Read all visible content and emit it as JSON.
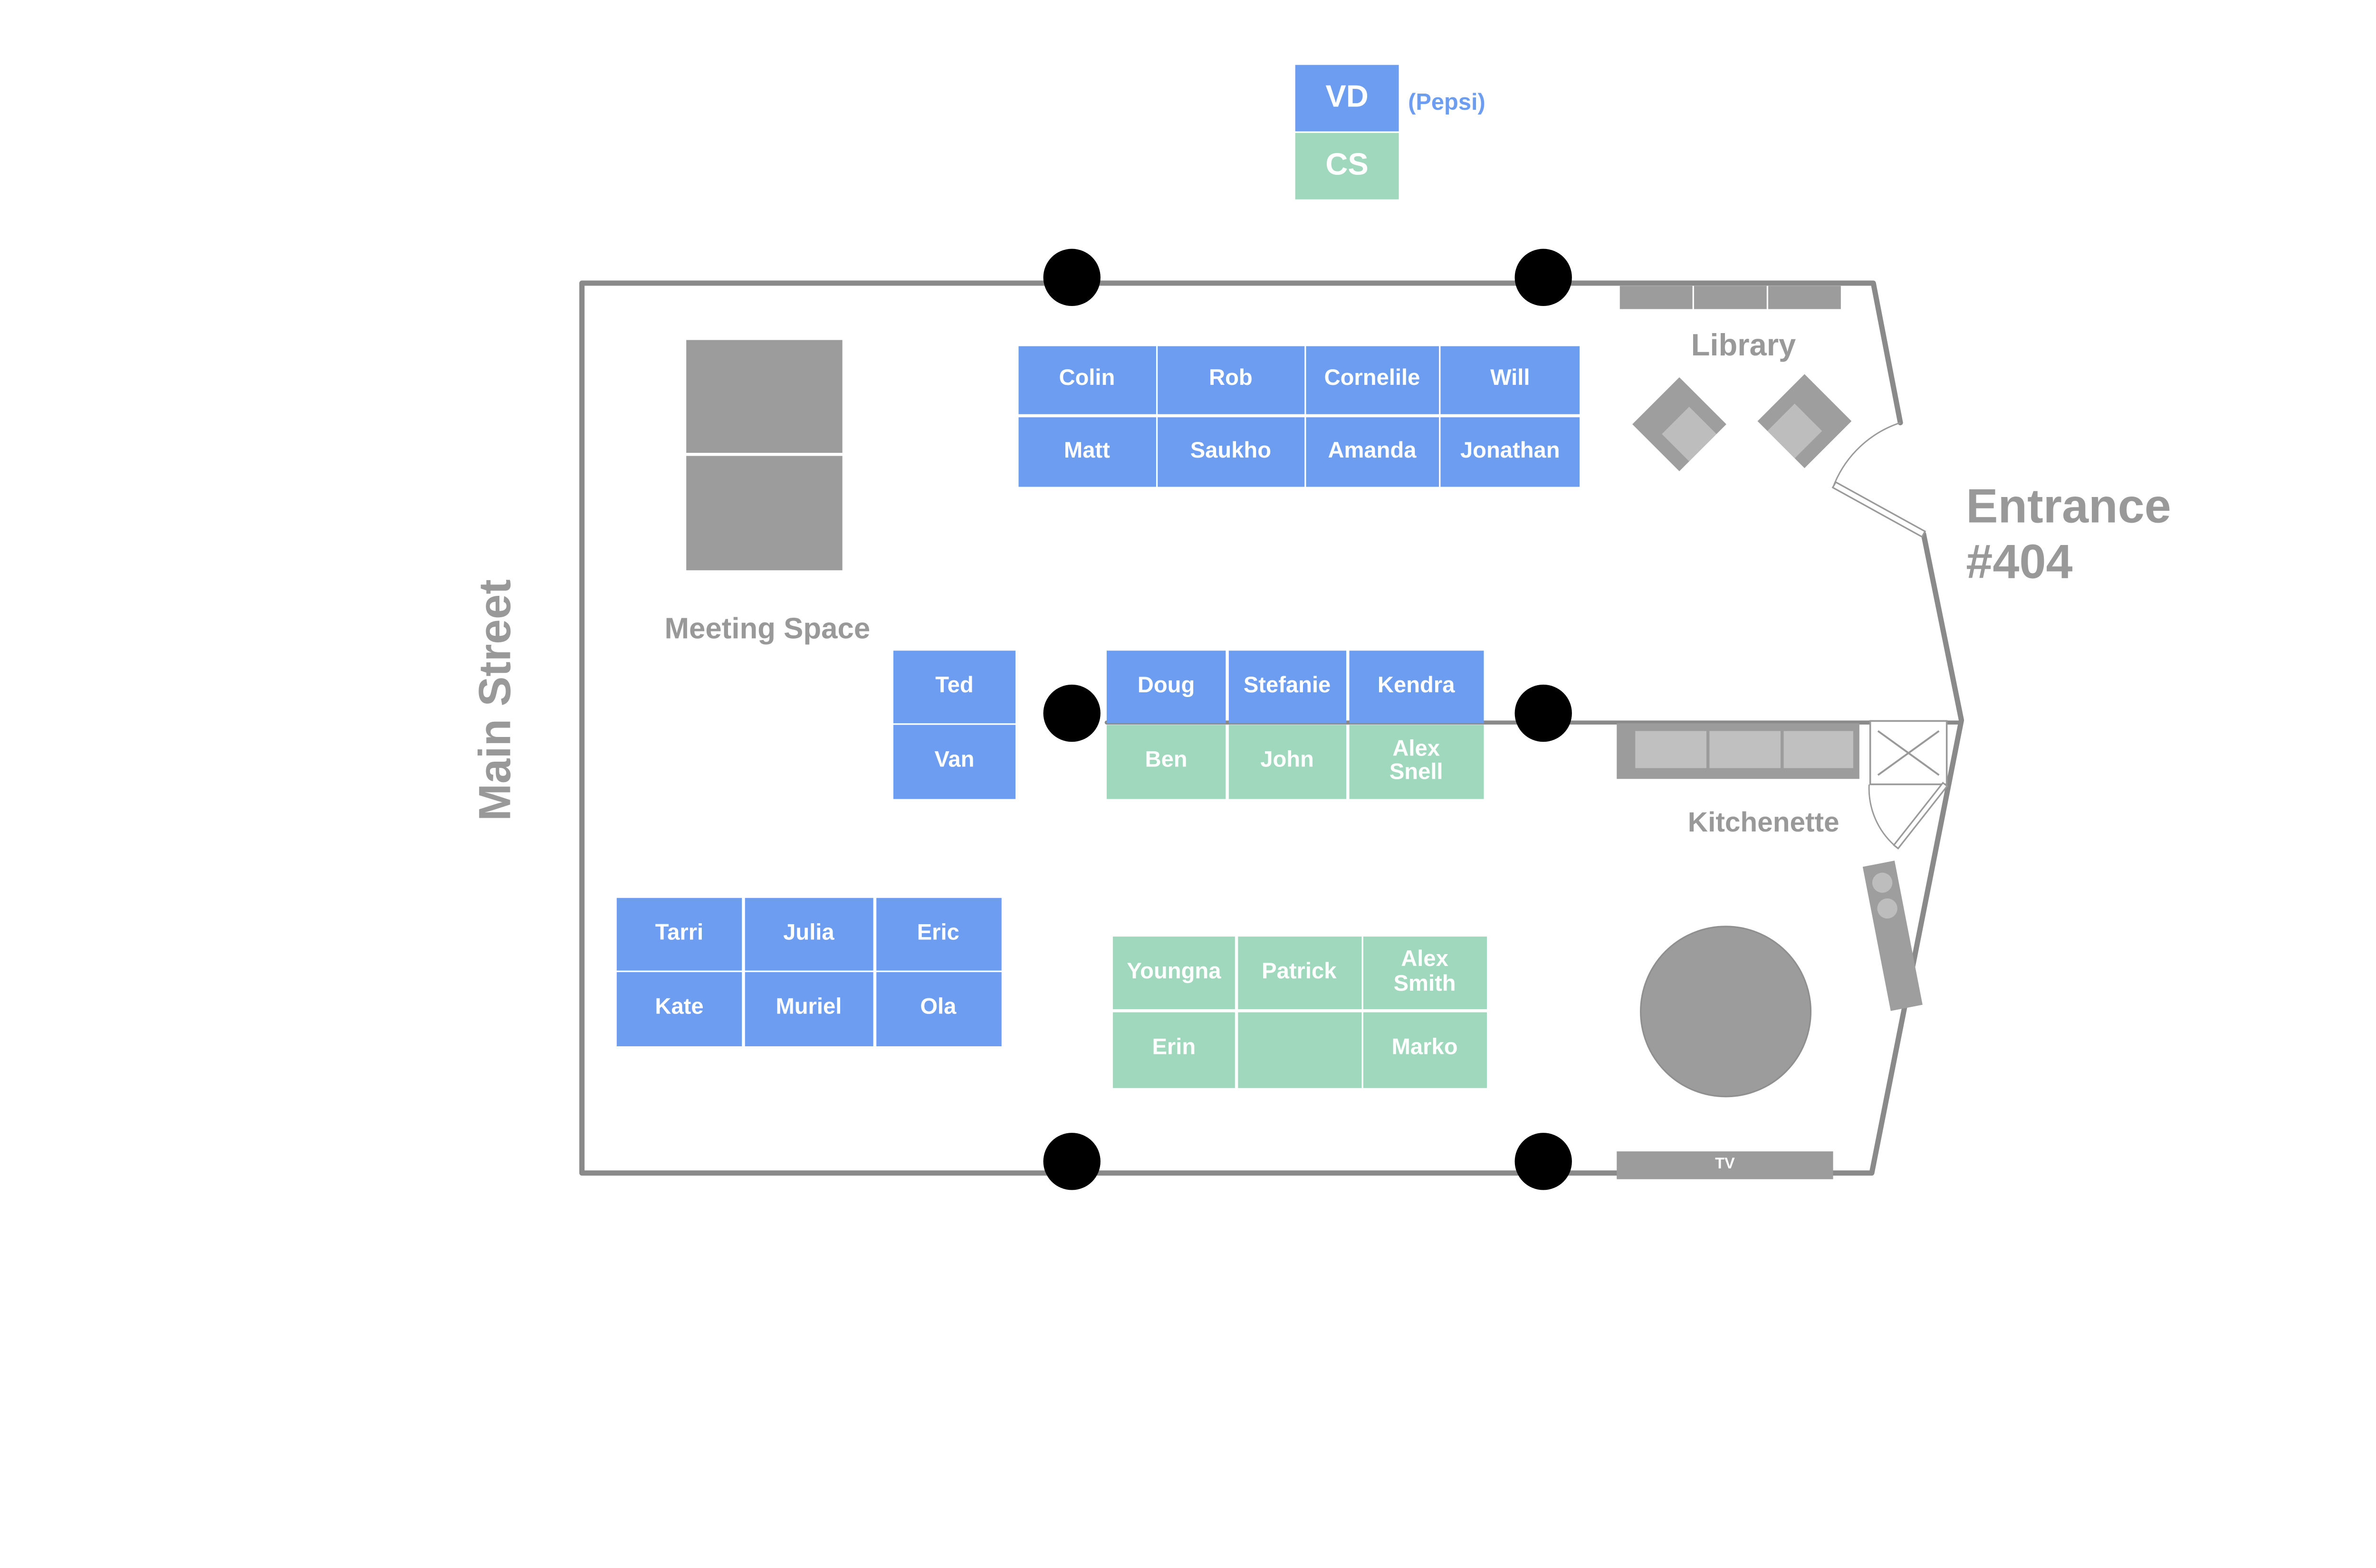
{
  "legend": {
    "vd": "VD",
    "cs": "CS",
    "note": "(Pepsi)"
  },
  "labels": {
    "main_street": "Main Street",
    "meeting_space": "Meeting Space",
    "library": "Library",
    "kitchenette": "Kitchenette",
    "entrance_line1": "Entrance",
    "entrance_line2": "#404",
    "tv": "TV"
  },
  "colors": {
    "desk_blue": "#6D9DF0",
    "desk_green": "#9FD8BC",
    "furniture": "#9C9C9C",
    "furniture_light": "#C0C0C0",
    "wall": "#8A8A8A",
    "label_text": "#999999",
    "column": "#000000"
  },
  "clusters": {
    "top": {
      "color": "blue",
      "rows": [
        [
          "Colin",
          "Rob",
          "Cornelile",
          "Will"
        ],
        [
          "Matt",
          "Saukho",
          "Amanda",
          "Jonathan"
        ]
      ]
    },
    "ted_van": {
      "color": "blue",
      "rows": [
        [
          "Ted"
        ],
        [
          "Van"
        ]
      ]
    },
    "middle_blue": {
      "color": "blue",
      "rows": [
        [
          "Doug",
          "Stefanie",
          "Kendra"
        ]
      ]
    },
    "middle_green": {
      "color": "green",
      "rows": [
        [
          "Ben",
          "John",
          "Alex\nSnell"
        ]
      ]
    },
    "bottom_left": {
      "color": "blue",
      "rows": [
        [
          "Tarri",
          "Julia",
          "Eric"
        ],
        [
          "Kate",
          "Muriel",
          "Ola"
        ]
      ]
    },
    "bottom_middle": {
      "color": "green",
      "rows": [
        [
          "Youngna",
          "Patrick",
          "Alex\nSmith"
        ],
        [
          "Erin",
          "",
          "Marko"
        ]
      ]
    }
  }
}
